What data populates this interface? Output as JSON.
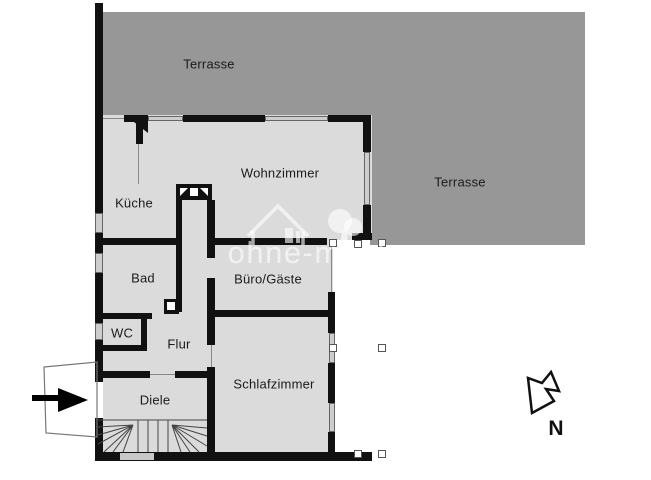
{
  "document_type": "apartment floor plan",
  "rooms": {
    "terrasse_top": {
      "label": "Terrasse"
    },
    "terrasse_right": {
      "label": "Terrasse"
    },
    "wohnzimmer": {
      "label": "Wohnzimmer"
    },
    "kueche": {
      "label": "Küche"
    },
    "bad": {
      "label": "Bad"
    },
    "wc": {
      "label": "WC"
    },
    "flur": {
      "label": "Flur"
    },
    "diele": {
      "label": "Diele"
    },
    "buero_gaeste": {
      "label": "Büro/Gäste"
    },
    "schlafzimmer": {
      "label": "Schlafzimmer"
    }
  },
  "compass": {
    "label": "N",
    "arrow_direction": "down-left"
  },
  "watermark": {
    "text": "ohne-makler"
  },
  "colors": {
    "terrace": "#979797",
    "floor": "#dbdbdb",
    "wall": "#111111",
    "background": "#ffffff",
    "watermark_text": "rgba(255,255,255,0.62)"
  }
}
